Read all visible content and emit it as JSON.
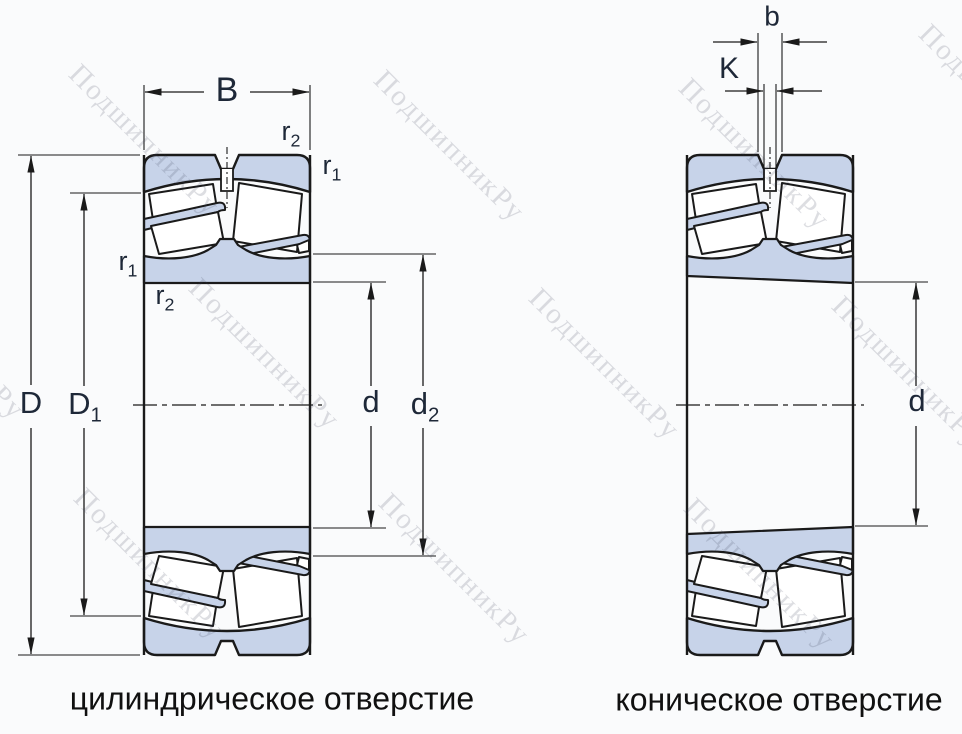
{
  "diagram": {
    "watermark_text": "ПодшипникРу",
    "colors": {
      "part_fill": "#c7d3e9",
      "line": "#1a1a1a",
      "dimension_text": "#1e2838",
      "caption_text": "#101010",
      "background": "#fafbfc"
    },
    "left_view": {
      "caption": "цилиндрическое отверстие",
      "labels": {
        "B": {
          "base": "B",
          "sub": ""
        },
        "r2_top": {
          "base": "r",
          "sub": "2"
        },
        "r1_right": {
          "base": "r",
          "sub": "1"
        },
        "r1_left": {
          "base": "r",
          "sub": "1"
        },
        "r2_left": {
          "base": "r",
          "sub": "2"
        },
        "D": {
          "base": "D",
          "sub": ""
        },
        "D1": {
          "base": "D",
          "sub": "1"
        },
        "d": {
          "base": "d",
          "sub": ""
        },
        "d2": {
          "base": "d",
          "sub": "2"
        }
      }
    },
    "right_view": {
      "caption": "коническое отверстие",
      "labels": {
        "b": {
          "base": "b",
          "sub": ""
        },
        "K": {
          "base": "K",
          "sub": ""
        },
        "d": {
          "base": "d",
          "sub": ""
        }
      }
    }
  }
}
